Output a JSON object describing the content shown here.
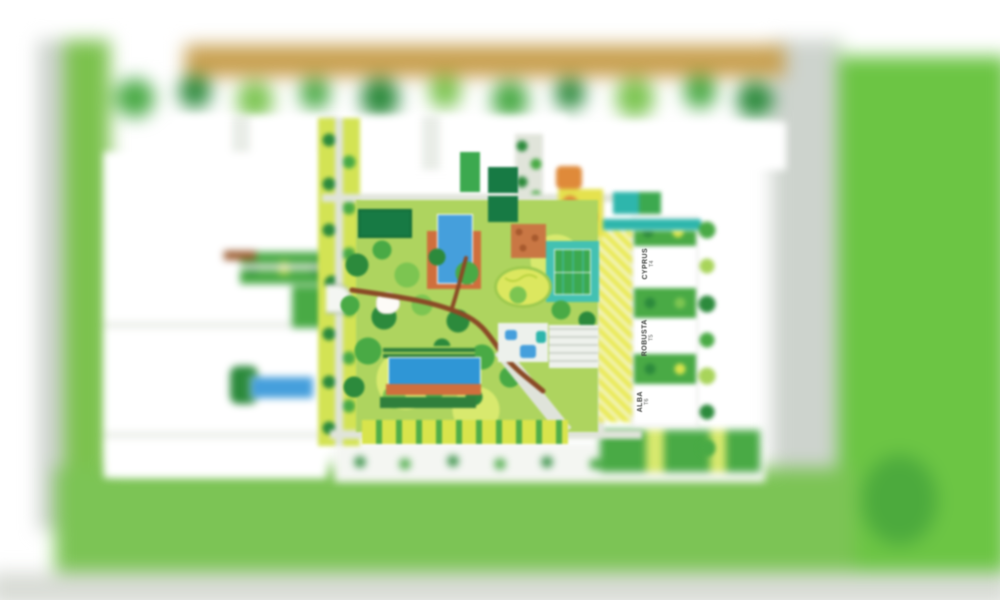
{
  "scene": {
    "description": "Blurred aerial master-plan rendering of a residential development with central landscaped courtyard, pools, tennis court and three labelled towers",
    "towers": [
      {
        "name": "CYPRUS",
        "code": "T4"
      },
      {
        "name": "ROBUSTA",
        "code": "T5"
      },
      {
        "name": "ALBA",
        "code": "T6"
      }
    ]
  },
  "colors": {
    "page": "#ffffff",
    "roadTan": "#c8a050",
    "fieldGreen": "#6cc544",
    "verge": "#7cc24e",
    "roadGray": "#cdd3cd",
    "bottomGray": "#d9dcd6",
    "lawnSouth": "#7cc455",
    "avenue": "#d3e354",
    "courtyard": "#aed45f",
    "courtyardLight": "#d8e96e",
    "plotDark": "#177a44",
    "treeDark": "#2c8a3c",
    "treeMid": "#49aa45",
    "treeLight": "#7cc551",
    "treeYellow": "#a8d45a",
    "poolBlue": "#459fdc",
    "poolBlueDeep": "#2f96d6",
    "deckOrange": "#cf6f3d",
    "tennisTeal": "#43c1b2",
    "courtGreen": "#3ca94f",
    "playOrange": "#df8a3a",
    "kidsYellow": "#e5e24e",
    "hatchYellow": "#e9e94e",
    "tealPool": "#2eb6ac",
    "pathGray": "#e0e4da",
    "building": "#ffffff",
    "buildingShade": "#e9ede7",
    "walkBrown": "#8a4a26",
    "plazaTerracotta": "#c97744",
    "hedgeDark": "#2f7f3c",
    "hedgeYellow": "#d8e44c",
    "ovalLawn": "#dce75f",
    "promenade": "#f4f6f2"
  }
}
